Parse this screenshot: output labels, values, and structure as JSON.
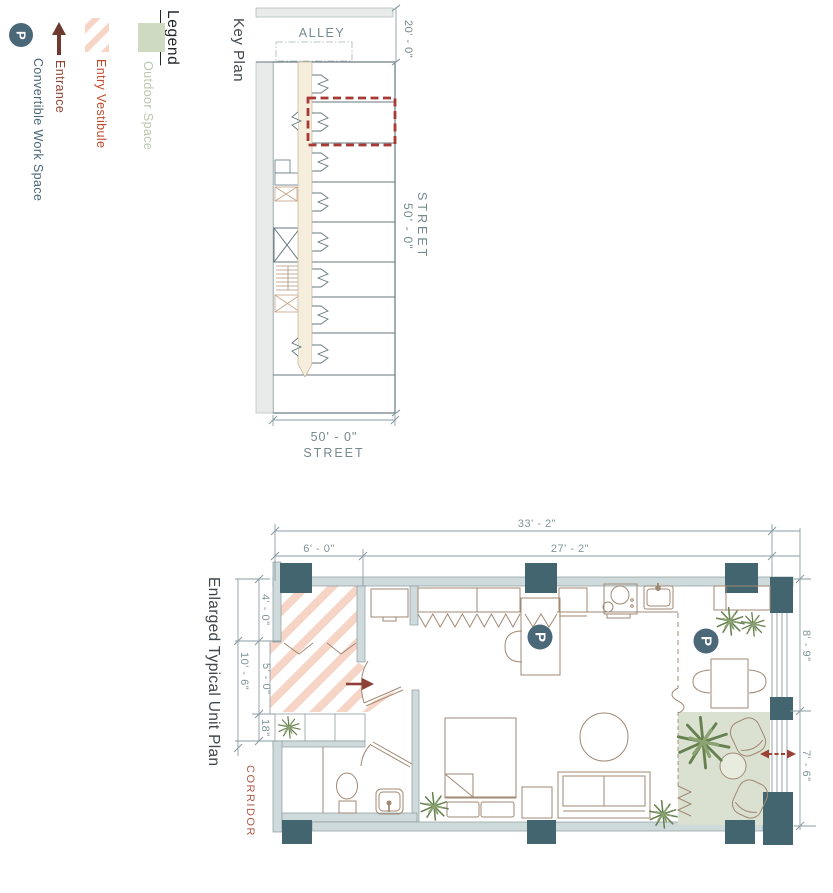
{
  "legend": {
    "title": "Legend",
    "outdoor": {
      "label": "Outdoor Space",
      "color": "#cfdac3",
      "text_color": "#b9c8ab"
    },
    "entry_vestibule": {
      "label": "Entry Vestibule",
      "stripe_color": "#f6d4c6",
      "text_color": "#c24a2b"
    },
    "entrance": {
      "label": "Entrance",
      "arrow_color": "#6e3a2f",
      "text_color": "#8f4534"
    },
    "work_space": {
      "label": "Convertible Work Space",
      "symbol": "P",
      "badge_color": "#4a6878",
      "text_color": "#4a6878"
    }
  },
  "key_plan": {
    "title": "Key Plan",
    "alley_label": "ALLEY",
    "alley_dim": "20' - 0\"",
    "street_right_label": "STREET",
    "street_right_dim": "50' - 0\"",
    "street_bottom_label": "STREET",
    "street_bottom_dim": "50' - 0\"",
    "highlight_color": "#a83a36"
  },
  "unit_plan": {
    "title": "Enlarged Typical Unit Plan",
    "corridor_label": "CORRIDOR",
    "work_space_symbol": "P",
    "column_color": "#42656f",
    "outdoor_color": "#dbe1d1",
    "dims": {
      "overall_width": "33' - 2\"",
      "vestibule_width": "6' - 0\"",
      "main_width": "27' - 2\"",
      "vestibule_depth": "4' - 0\"",
      "left_depth": "10' - 6\"",
      "entry_depth": "5' - 0\"",
      "shelf_depth": "18\"",
      "right_upper_depth": "8' - 9\"",
      "right_lower_depth": "7' - 6\""
    }
  }
}
